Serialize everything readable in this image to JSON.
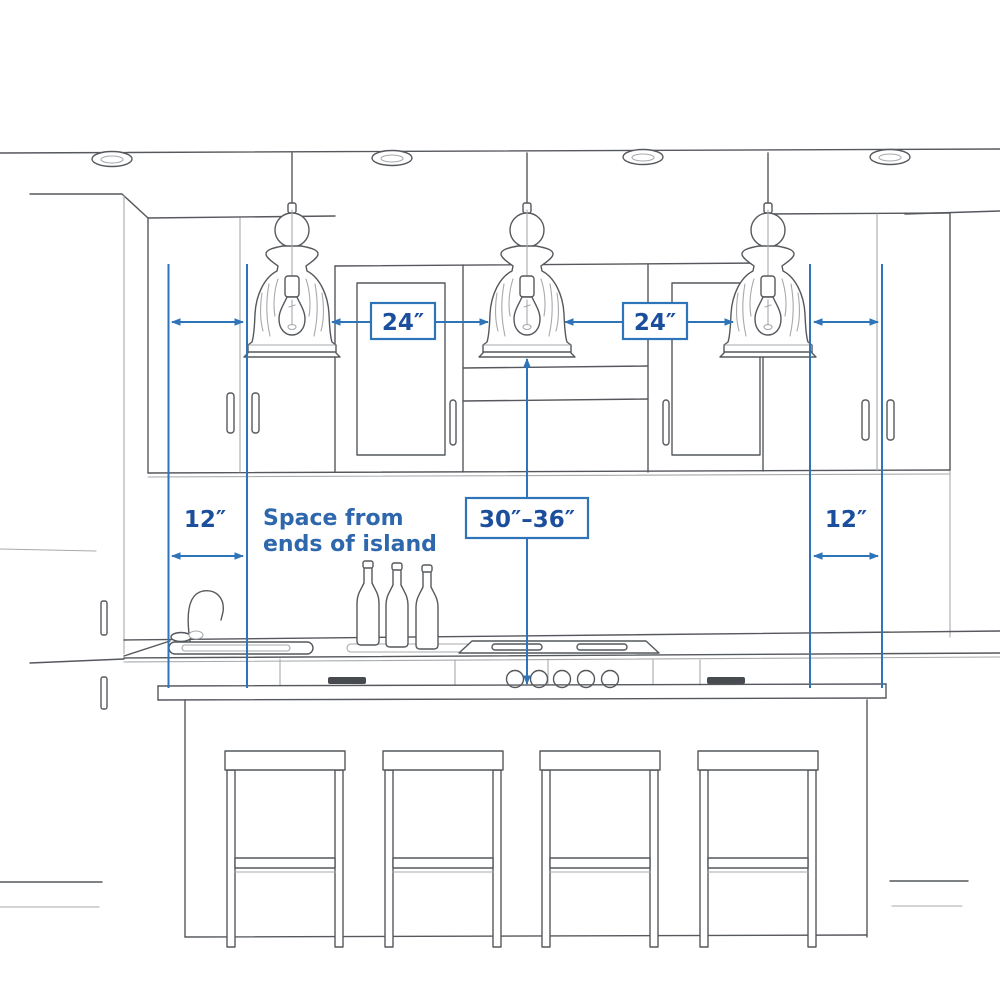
{
  "colors": {
    "annotation_blue": "#2E74B9",
    "dimension_text": "#1B4F9E",
    "note_text": "#2E67AC",
    "sketch_line": "#55585D"
  },
  "labels": {
    "pendant_spacing_left": "24″",
    "pendant_spacing_right": "24″",
    "island_end_left": "12″",
    "island_end_right": "12″",
    "pendant_height_range": "30″–36″",
    "note_line1": "Space from",
    "note_line2": "ends of island"
  },
  "scene": {
    "recessed_lights": 4,
    "pendant_lights": 3,
    "wine_bottles": 3,
    "cooktop_knobs": 5,
    "bar_stools": 4
  }
}
